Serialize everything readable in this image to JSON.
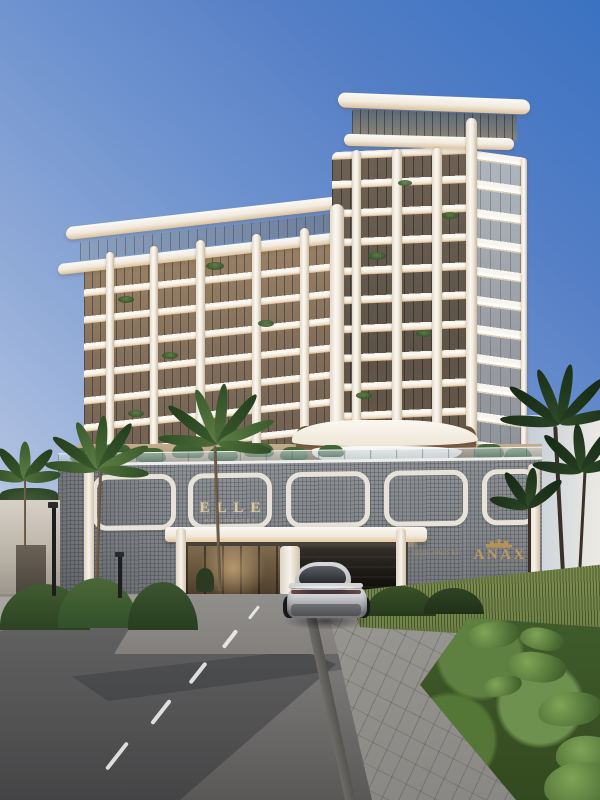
{
  "scene": {
    "title": "ELLE Residences tower - exterior architectural rendering",
    "setting": "street-level view of a curved-balcony condo tower over a mesh-clad podium with driveway entrance, palms and a silver coupe",
    "sky": "clear blue gradient, hazy at horizon",
    "signage": {
      "brand": "ELLE",
      "brand_sub": "RESIDENCES",
      "developer_prefix": "DEVELOPED BY",
      "developer_name": "ANAX",
      "developer_sub": "DEVELOPMENTS"
    },
    "palette": {
      "sky_top": "#3a72c1",
      "sky_horizon": "#dfe1e2",
      "tower_white": "#faf7f1",
      "balcony_glow": "#e2bf95",
      "glass_warm": "#84705c",
      "podium_mesh": "#84878c",
      "signage_gold": "#b59357",
      "asphalt": "#6f6d6c",
      "foliage": "#415c31",
      "car_silver": "#cfd0d3"
    }
  }
}
